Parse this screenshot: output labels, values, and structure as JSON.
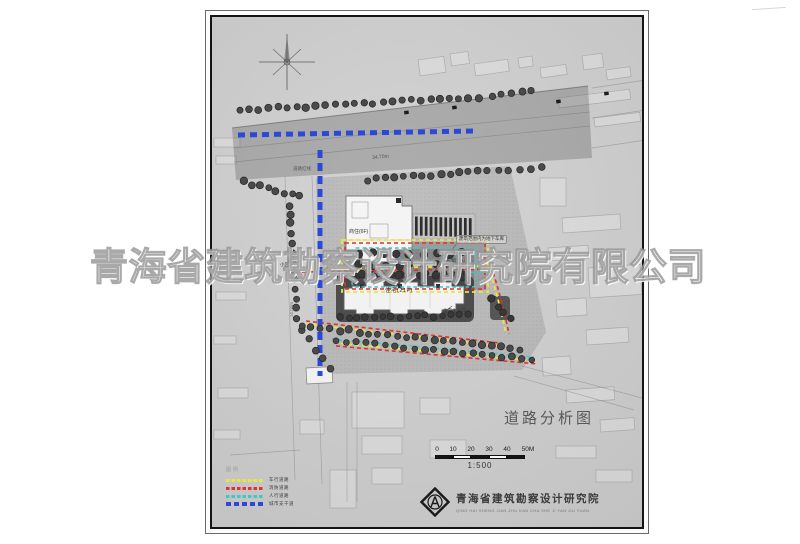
{
  "title": {
    "text": "道路分析图"
  },
  "scalebar": {
    "ticks": [
      "0",
      "10",
      "20",
      "30",
      "40",
      "50M"
    ],
    "ratio": "1:500"
  },
  "legend": {
    "header": "图例",
    "items": [
      {
        "label": "车行道路",
        "color": "#e8e838"
      },
      {
        "label": "消防道路",
        "color": "#e03030"
      },
      {
        "label": "人行道路",
        "color": "#3cc8c8"
      },
      {
        "label": "城市支干道",
        "color": "#2b49d6"
      }
    ]
  },
  "annotations": {
    "road_redline": "道路红线",
    "dim_34": "34.70m",
    "dim_36": "36.50m",
    "dim_16": "16.00m",
    "bldg_shop": "商住(6F)",
    "bldg_res": "住宅(21F)",
    "garage_note": "建筑范围内为地下车库",
    "garage_entry": "车库出入口",
    "res_entry": "住宅主入口",
    "community_entry": "小区入口"
  },
  "publisher": {
    "name": "青海省建筑勘察设计研究院",
    "pinyin": "QING HAI SHENG JIAN ZHU KAN CHA SHE JI YAN JIU YUAN"
  },
  "watermark": {
    "text": "青海省建筑勘察设计研究院有限公司"
  },
  "colors": {
    "band": "rgba(82,82,82,0.30)",
    "site": "rgba(75,75,75,0.16)",
    "blue": "#2b49d6",
    "yellow": "#e8e838",
    "red": "#e03030",
    "cyan": "#3cc8c8",
    "tree": "#4a4a4a",
    "tree_dark": "#383838"
  },
  "icons": {
    "compass": "north-arrow-icon",
    "logo": "institute-seal-icon"
  }
}
